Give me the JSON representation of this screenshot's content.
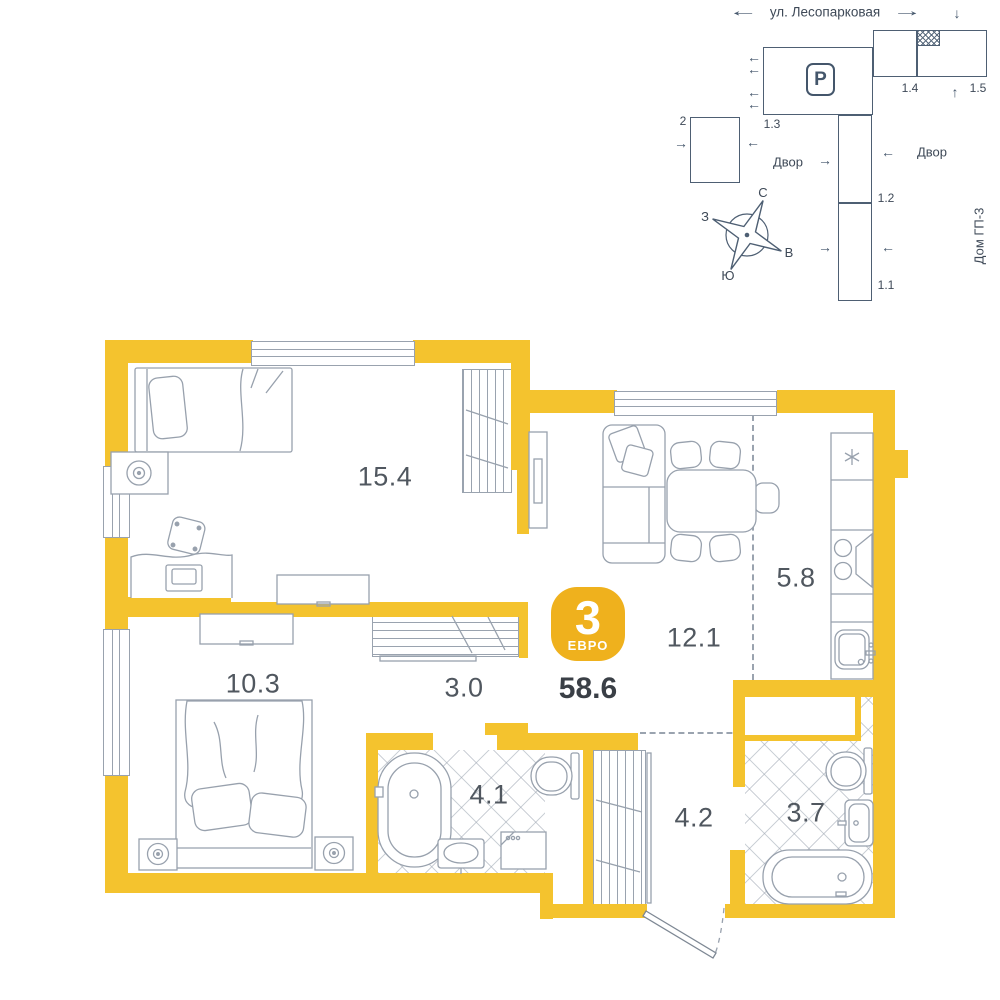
{
  "plan": {
    "badge": {
      "rooms_count": "3",
      "layout_type": "ЕВРО",
      "total_area": "58.6"
    },
    "areas": {
      "room": "15.4",
      "living_kitchen": "12.1",
      "kitchen_zone": "5.8",
      "bedroom": "10.3",
      "corridor": "3.0",
      "bathroom": "4.1",
      "hallway": "4.2",
      "bathroom_2": "3.7"
    }
  },
  "map": {
    "street": "ул. Лесопарковая",
    "parking_label": "P",
    "blocks": {
      "b2": "2",
      "b11": "1.1",
      "b12": "1.2",
      "b13": "1.3",
      "b14": "1.4",
      "b15": "1.5"
    },
    "yard_left": "Двор",
    "yard_right": "Двор",
    "house": "Дом ГП-3",
    "compass": {
      "n": "С",
      "e": "В",
      "s": "Ю",
      "w": "З"
    }
  },
  "icons": {
    "arrow_left": "←",
    "arrow_right": "→",
    "arrow_up": "↑",
    "arrow_down": "↓"
  },
  "colors": {
    "wall": "#F4C32E",
    "badge": "#EFB11D",
    "furniture_line": "#98A1AD",
    "map_line": "#4E5F73",
    "map_text": "#3E4957",
    "area_label": "#50575F",
    "total_label": "#3A3F46"
  }
}
